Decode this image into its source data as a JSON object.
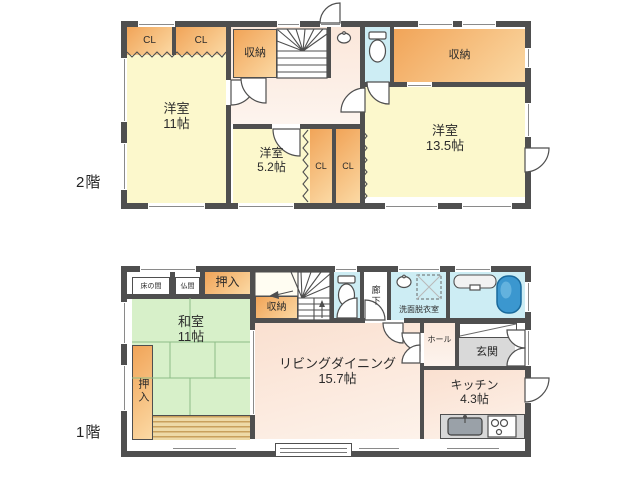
{
  "canvas": {
    "width": 640,
    "height": 480
  },
  "floor2": {
    "label": "2階",
    "rooms": {
      "cl1": "CL",
      "cl2": "CL",
      "cl3": "CL",
      "cl4": "CL",
      "storage_left": "収納",
      "storage_right": "収納",
      "room11_name": "洋室",
      "room11_size": "11帖",
      "room52_name": "洋室",
      "room52_size": "5.2帖",
      "room135_name": "洋室",
      "room135_size": "13.5帖"
    }
  },
  "floor1": {
    "label": "1階",
    "rooms": {
      "tokonoma": "床の間",
      "butsuma": "仏間",
      "oshiire_top": "押入",
      "oshiire_side": "押入",
      "storage": "収納",
      "corridor": "廊下",
      "washroom": "洗面脱衣室",
      "washitsu_name": "和室",
      "washitsu_size": "11帖",
      "living_name": "リビングダイニング",
      "living_size": "15.7帖",
      "hall": "ホール",
      "entrance": "玄関",
      "kitchen_name": "キッチン",
      "kitchen_size": "4.3帖"
    }
  },
  "icons": [
    "toilet-icon",
    "hand-sink-icon",
    "washbasin-icon",
    "washing-machine-pan-icon",
    "bathtub-icon",
    "kitchen-sink-icon",
    "gas-stove-icon",
    "stairs-icon",
    "stairs-up-arrow-icon",
    "door-swing-icon",
    "double-door-icon",
    "folding-door-icon",
    "bay-window-icon"
  ],
  "colors": {
    "wall": "#4f4f4f",
    "room-yellow": "#fcf8cc",
    "closet-orange-1": "#f1a458",
    "closet-orange-2": "#fbd9a4",
    "hall-pink": "#fbe7da",
    "living-pink": "#fae0d0",
    "tatami-green": "#d7f0c9",
    "tatami-line": "#8cbd86",
    "water-blue": "#cdedf4",
    "bathtub-blue": "#3b97cf",
    "entrance-gray": "#d9d9d9",
    "counter-gray": "#d8d8d8",
    "engawa-dark": "#c9a05c",
    "engawa-light": "#eed9a6",
    "text": "#2b2b2b",
    "floor-bg": "#ffffff"
  }
}
